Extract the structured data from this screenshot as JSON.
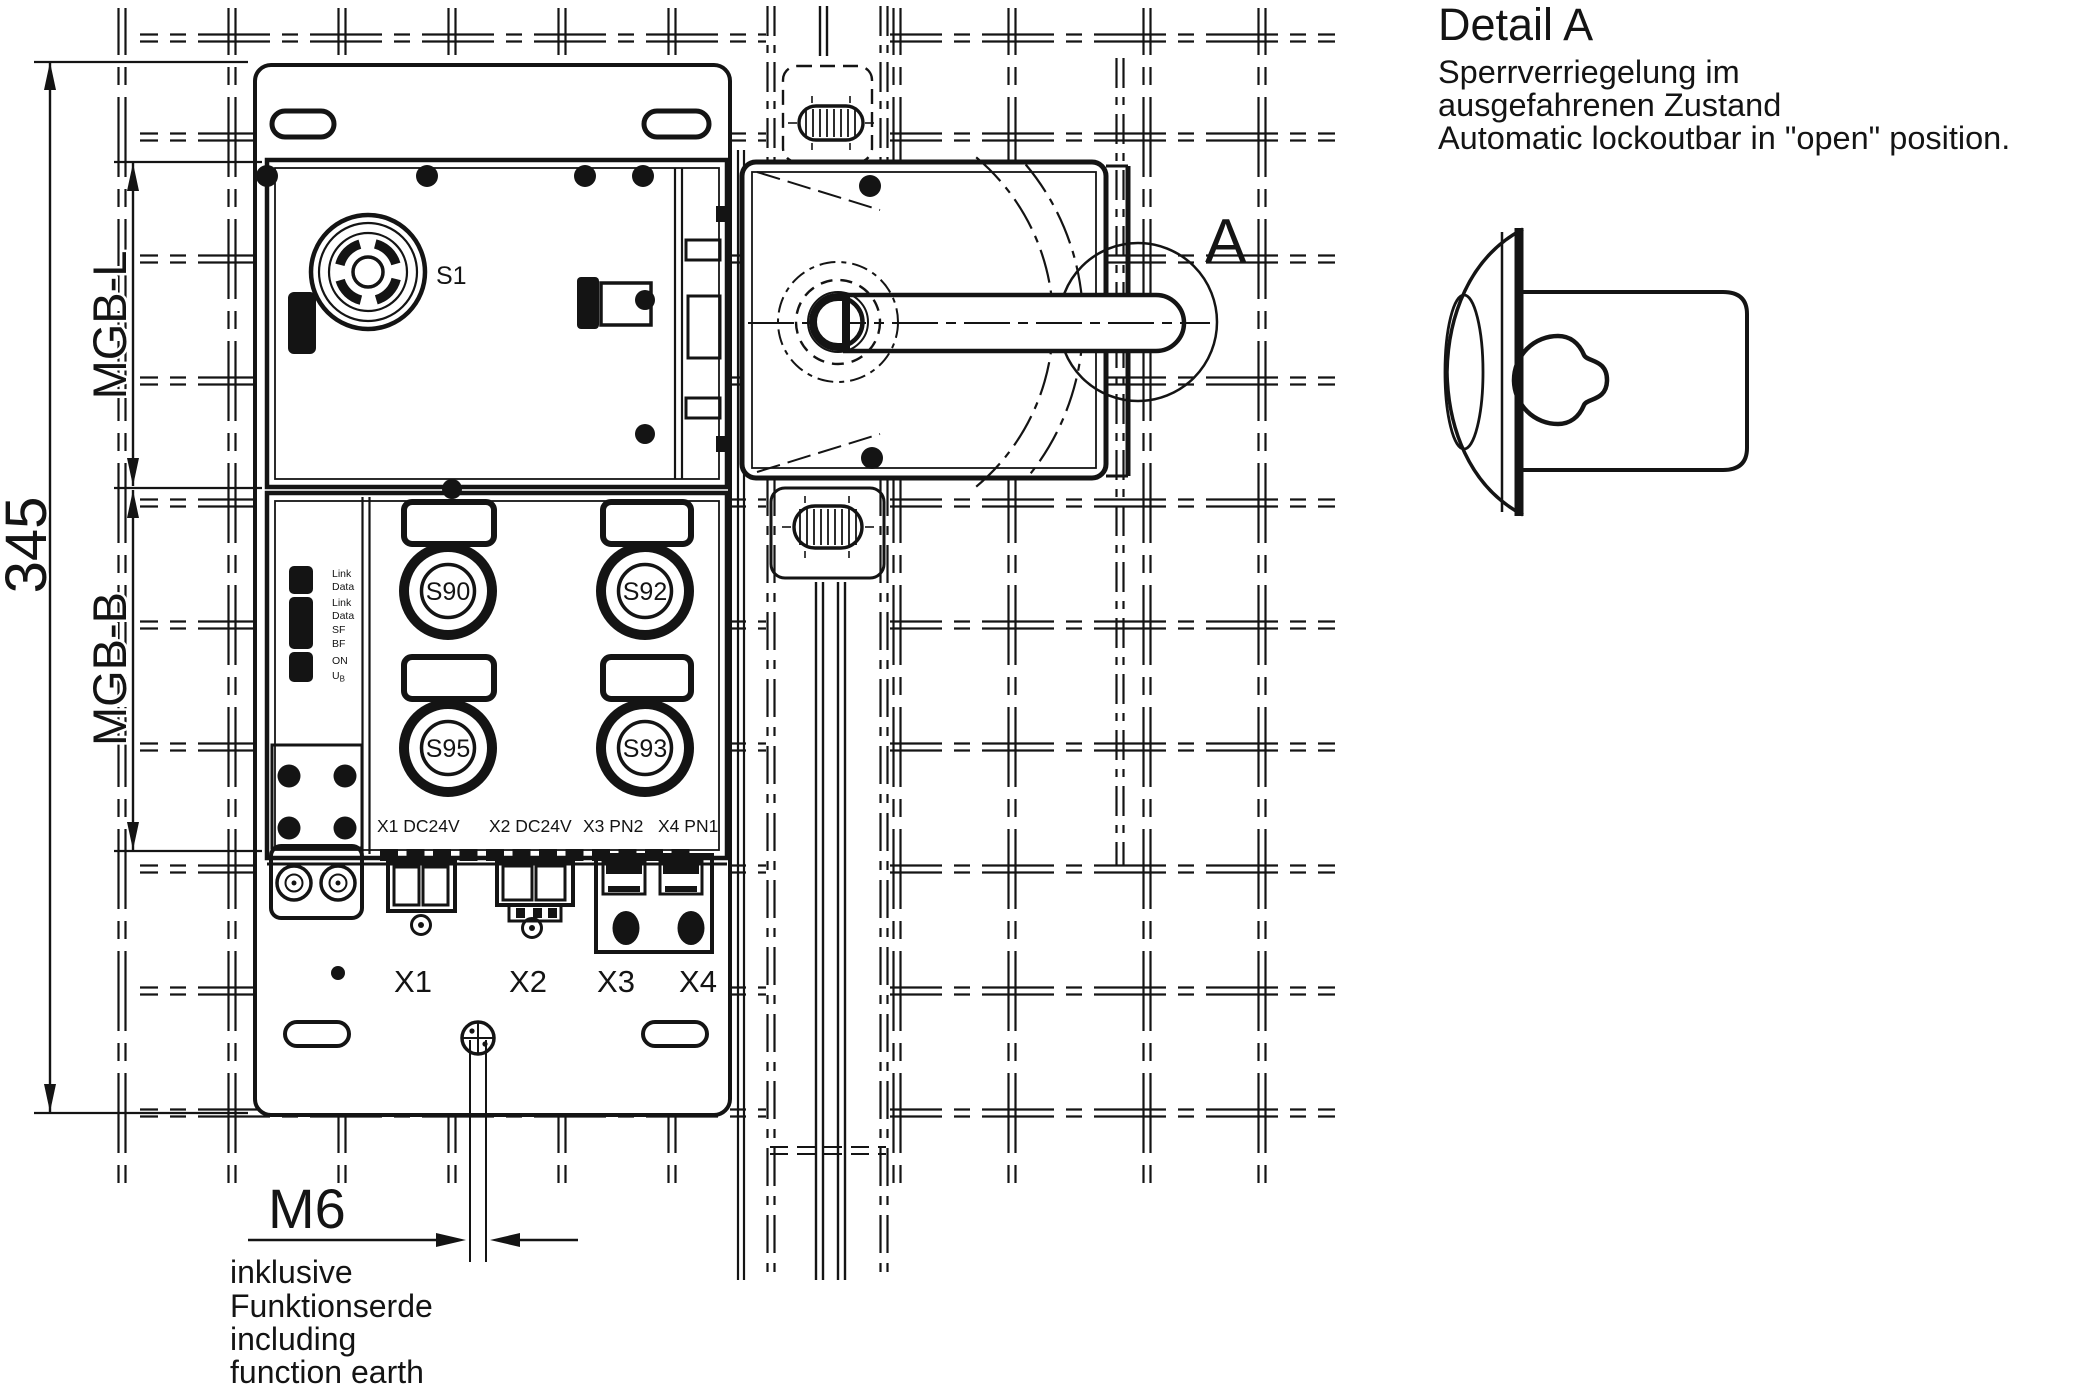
{
  "note": {
    "heading": "Detail A",
    "de1": "Sperrverriegelung im",
    "de2": "ausgefahrenen Zustand",
    "en": "Automatic lockoutbar in \"open\" position."
  },
  "dimensions": {
    "overall": "345",
    "upper_module": "MGB-L",
    "lower_module": "MGB-B",
    "thread": "M6"
  },
  "footnote": [
    "inklusive",
    "Funktionserde",
    "including",
    "function earth"
  ],
  "device": {
    "estop": "S1",
    "buttons": [
      {
        "label": "S90"
      },
      {
        "label": "S92"
      },
      {
        "label": "S95"
      },
      {
        "label": "S93"
      }
    ],
    "connectors": [
      "X1 DC24V",
      "X2 DC24V",
      "X3 PN2",
      "X4 PN1"
    ],
    "ports": [
      "X1",
      "X2",
      "X3",
      "X4"
    ],
    "leds": [
      "Link",
      "Data",
      "Link",
      "Data",
      "SF",
      "BF",
      "ON"
    ],
    "ub": {
      "main": "U",
      "sub": "B"
    }
  },
  "detail_marker": "A",
  "colors": {
    "line": "#141414",
    "background": "#ffffff"
  }
}
